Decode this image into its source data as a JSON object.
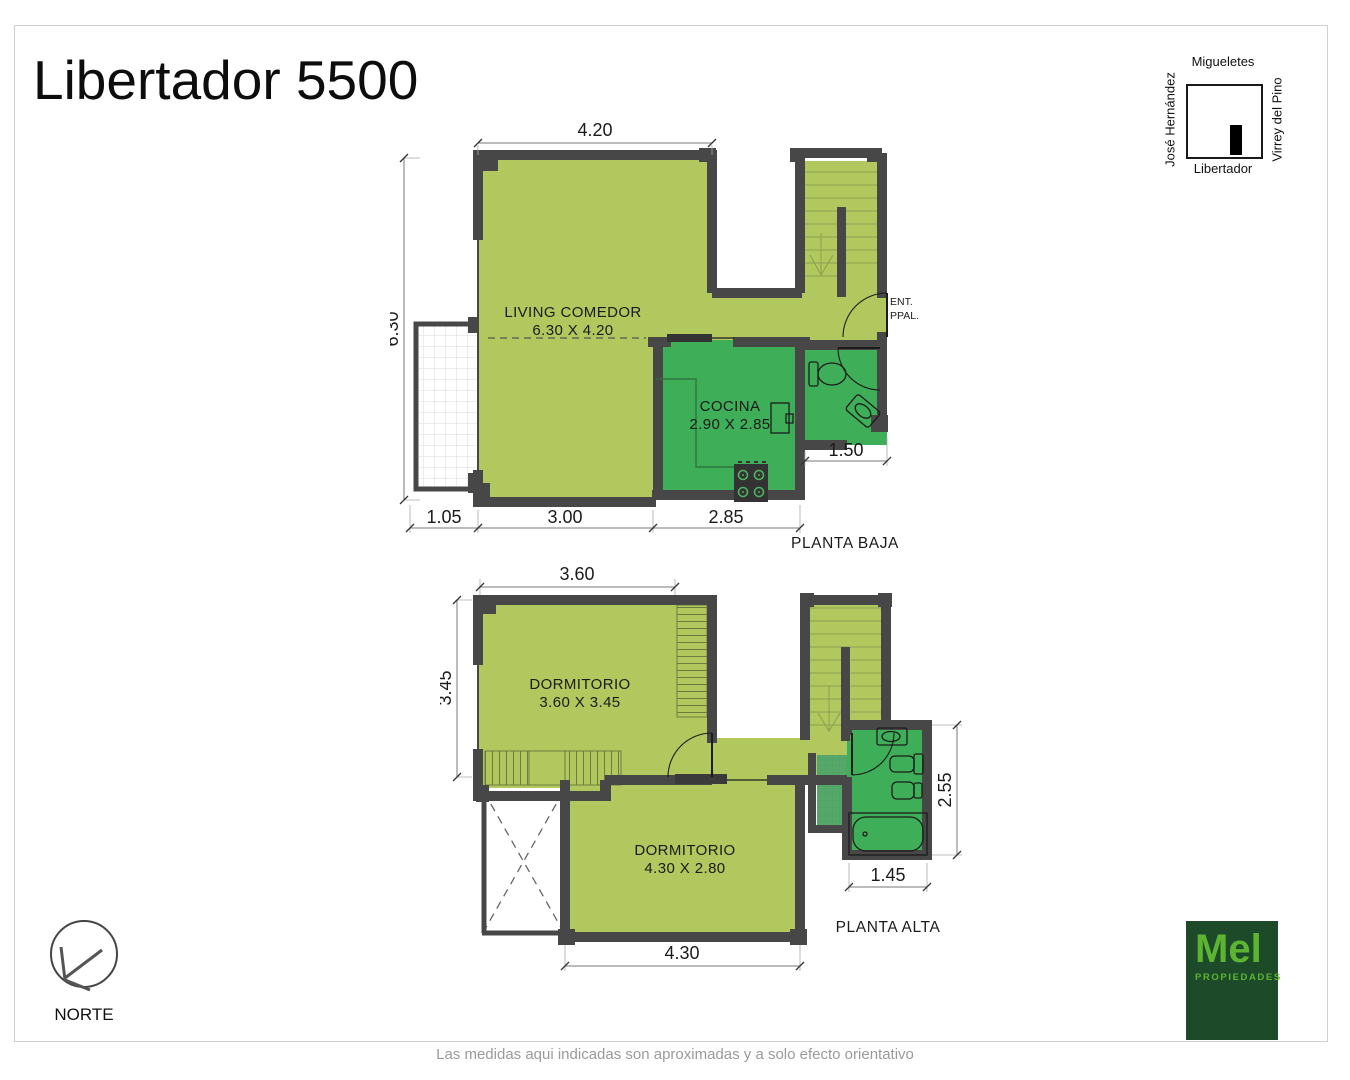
{
  "title": "Libertador 5500",
  "footer": "Las medidas aqui indicadas son aproximadas y a solo efecto orientativo",
  "colors": {
    "room_light": "#b2c85e",
    "room_dark": "#3fae58",
    "shaft_green": "#55a869",
    "wall": "#474747",
    "logo_bg": "#1d4a28",
    "logo_green": "#5cb431"
  },
  "minimap": {
    "top": "Migueletes",
    "left": "José Hernández",
    "right": "Virrey del Pino",
    "bottom": "Libertador"
  },
  "compass": {
    "label": "NORTE"
  },
  "logo": {
    "brand": "Mel",
    "subtitle": "PROPIEDADES"
  },
  "planta_baja": {
    "label": "PLANTA BAJA",
    "living": {
      "name": "LIVING COMEDOR",
      "size": "6.30 X 4.20"
    },
    "kitchen": {
      "name": "COCINA",
      "size": "2.90 X 2.85"
    },
    "entrance": {
      "line1": "ENT.",
      "line2": "PPAL."
    },
    "dims": {
      "top": "4.20",
      "left": "6.30",
      "balcony": "1.05",
      "bottom_living": "3.00",
      "bottom_kitchen": "2.85",
      "bath": "1.50"
    }
  },
  "planta_alta": {
    "label": "PLANTA ALTA",
    "bedroom1": {
      "name": "DORMITORIO",
      "size": "3.60 X 3.45"
    },
    "bedroom2": {
      "name": "DORMITORIO",
      "size": "4.30 X 2.80"
    },
    "dims": {
      "top": "3.60",
      "left": "3.45",
      "bottom": "4.30",
      "bath_w": "1.45",
      "bath_h": "2.55"
    }
  }
}
